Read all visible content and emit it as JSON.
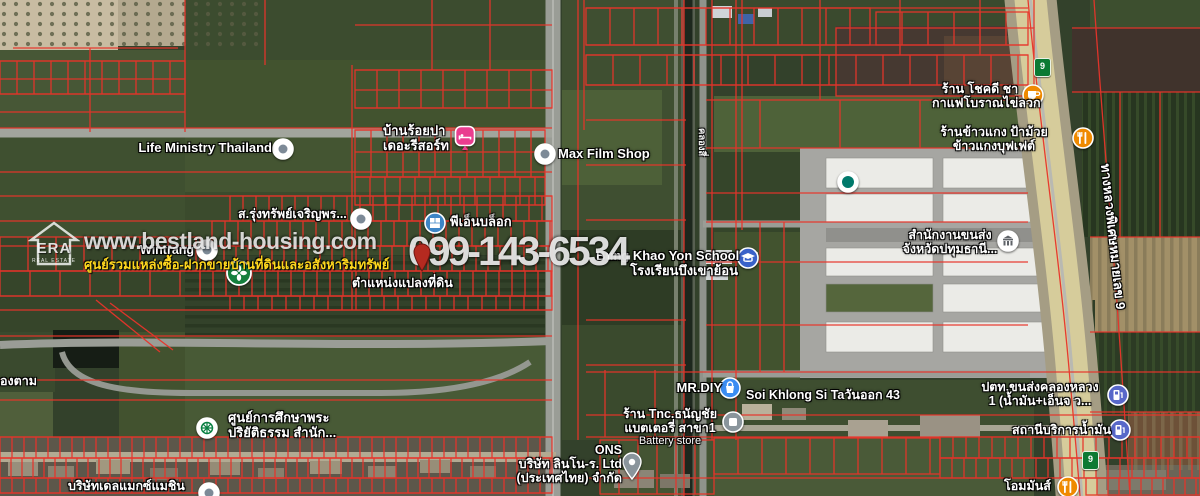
{
  "brand": {
    "logo_text": "ERA",
    "logo_subtext": "REAL ESTATE",
    "website": "www.bestland-housing.com",
    "tagline": "ศูนย์รวมแหล่งซื้อ-ฝากขายบ้านที่ดินและอสังหาริมทรัพย์",
    "phone": "099-143-6534"
  },
  "annotation": {
    "parcel_label": "ตำแหน่งแปลงที่ดิน",
    "pin_color": "#b52a20"
  },
  "roads": {
    "motorway_label": "ทางหลวงพิเศษหมายเลข 9",
    "route_shield": "9",
    "canal_label": "คลองสี่"
  },
  "colors": {
    "parcel_line": "#e8342a",
    "water": "#1d271d",
    "highway_pavement": "#d6cc9b",
    "label_yellow": "#ffd81e"
  },
  "pois": [
    {
      "id": "life-ministry",
      "icon": "place-dot",
      "lines": [
        "Life Ministry Thailand"
      ]
    },
    {
      "id": "resort",
      "icon": "lodging",
      "lines": [
        "บ้านร้อยปา",
        "เดอะรีสอร์ท"
      ]
    },
    {
      "id": "max-film-shop",
      "icon": "place-dot",
      "lines": [
        "Max Film Shop"
      ]
    },
    {
      "id": "pn-block",
      "icon": "shop-blue",
      "lines": [
        "พีเอ็นบล็อก"
      ]
    },
    {
      "id": "s-rung-sap",
      "icon": "place-dot",
      "lines": [
        "ส.รุ่งทรัพย์เจริญพร..."
      ]
    },
    {
      "id": "wintrang",
      "icon": "place-dot",
      "lines": [
        "Wintrang"
      ]
    },
    {
      "id": "green-brand",
      "icon": "green-logo",
      "lines": []
    },
    {
      "id": "bung-khao-yon-school",
      "icon": "school",
      "lines": [
        "Bung Khao Yon School",
        "โรงเรียนบึงเขาย้อน"
      ]
    },
    {
      "id": "transport-office",
      "icon": "gov-building",
      "lines": [
        "สำนักงานขนส่ง",
        "จังหวัดปทุมธานี..."
      ]
    },
    {
      "id": "depot-marker",
      "icon": "teal-dot",
      "lines": []
    },
    {
      "id": "chokdee-coffee",
      "icon": "cafe",
      "lines": [
        "ร้าน โชคดี ชา",
        "กาแฟโบราณไข่ลวก"
      ]
    },
    {
      "id": "rice-curry-buffet",
      "icon": "restaurant",
      "lines": [
        "ร้านข้าวแกง ป้าม้วย",
        "ข้าวแกงบุฟเฟต์"
      ]
    },
    {
      "id": "mr-diy",
      "icon": "store-blue",
      "lines": [
        "MR.DIY"
      ]
    },
    {
      "id": "soi-khlong-si",
      "icon": "none",
      "lines": [
        "Soi Khlong Si Taวันออก 43"
      ]
    },
    {
      "id": "tnc-battery",
      "icon": "gray-dot",
      "lines": [
        "ร้าน Tnc.ธนัญชัย",
        "แบตเตอรี่ สาขา1",
        "Battery store"
      ]
    },
    {
      "id": "linno-co",
      "icon": "gray-pin",
      "lines": [
        "ONS",
        "บริษัท ลินโน-ร. Ltd",
        "(ประเทศไทย) จำกัด"
      ]
    },
    {
      "id": "dharma-school",
      "icon": "dharma-wheel",
      "lines": [
        "ศูนย์การศึกษาพระ",
        "ปริยัติธรรม สำนัก..."
      ]
    },
    {
      "id": "delmax-machine",
      "icon": "none",
      "lines": [
        "บริษัทเดลแมกซ์แมชิน"
      ]
    },
    {
      "id": "delmax-dot",
      "icon": "place-dot",
      "lines": []
    },
    {
      "id": "nong-tam",
      "icon": "none",
      "lines": [
        "องตาม"
      ]
    },
    {
      "id": "ptt-khlong-luang",
      "icon": "fuel",
      "lines": [
        "ปตท.ขนส่งคลองหลวง",
        "1 (น้ำมัน+เอ็นจ ว..."
      ]
    },
    {
      "id": "fuel-station",
      "icon": "fuel",
      "lines": [
        "สถานีบริการน้ำมัน"
      ]
    },
    {
      "id": "hom-man",
      "icon": "restaurant",
      "lines": [
        "โอมมันส์"
      ]
    }
  ]
}
